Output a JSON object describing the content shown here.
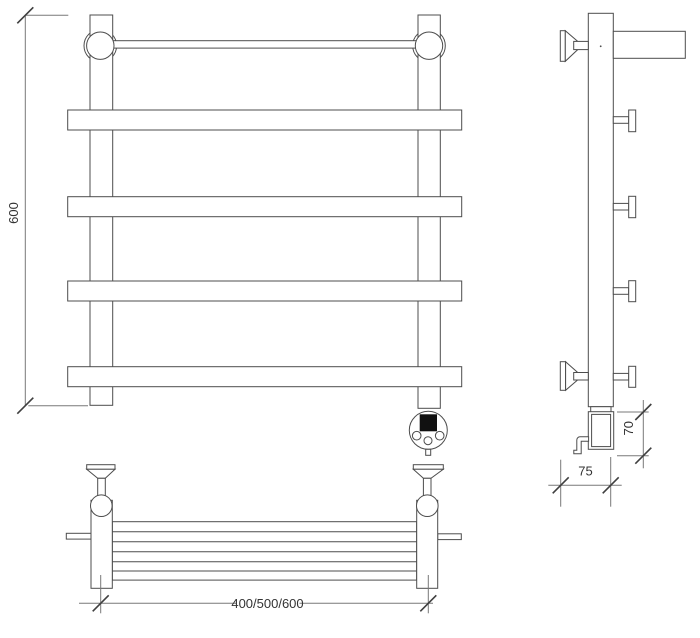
{
  "page": {
    "background": "#ffffff"
  },
  "drawing": {
    "line_color": "#4d4d4d",
    "dimension_line_color": "#787878",
    "tick_color": "#3f3f3f",
    "text_color": "#333333",
    "knob_display_color": "#111111",
    "views": [
      "front-view",
      "side-view",
      "top-view"
    ],
    "subject": "towel-rail-technical-drawing"
  },
  "labels": {
    "overall_height": "600",
    "width_variants": "400/500/600",
    "element_height": "70",
    "wall_distance": "75"
  }
}
